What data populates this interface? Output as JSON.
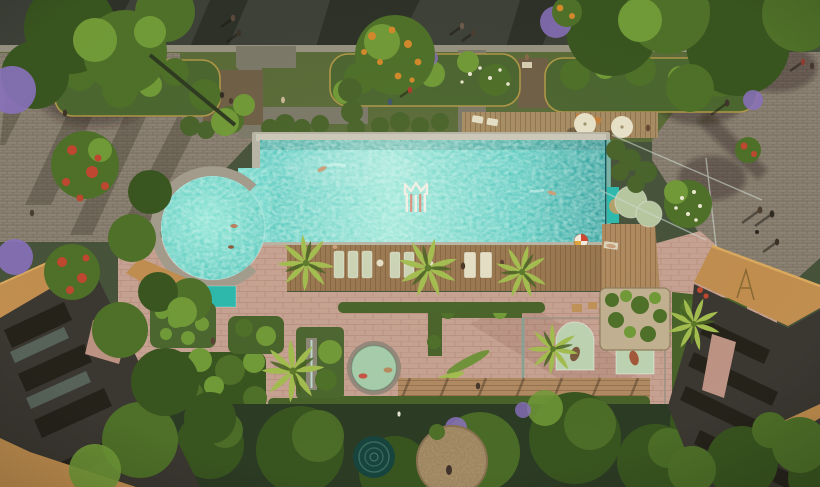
{
  "scene": {
    "alt": "Aerial rendering of a resort-style courtyard: large turquoise swimming pool with circular plunge pool and M monogram on the pool floor, wooden sun deck with loungers and palm trees, tropical garden terrace with spa jacuzzi and arched cabanas, brick plazas with pedestrians, a tree-lined road on top, and tan-roofed residential buildings at the lower corners",
    "logo_monogram": "M"
  },
  "palette": {
    "asphalt": "#3e4138",
    "sidewalk": "#989281",
    "plaza": "#8d8374",
    "garden_base": "#5a6b38",
    "path_gray": "#7d7969",
    "terrace_brown": "#6f5f46",
    "bed_green": "#4c6630",
    "bed_curb": "#af9747",
    "hedge": "#48632a",
    "canopy_dark": "#39551f",
    "canopy": "#4e7028",
    "canopy_light": "#719a37",
    "palm": "#a3bd4e",
    "flower_red": "#bf4730",
    "flower_purple": "#8971bd",
    "flower_orange": "#d3892b",
    "flower_white": "#ece9d2",
    "pool_coping": "#b9b5a6",
    "pool_mosaic": "#cdc9ba",
    "pool_light": "#8fe3d6",
    "pool_mid": "#46c4ba",
    "pool_deep": "#1f9694",
    "circle_pool_light": "#7fe4d4",
    "circle_pool": "#3fc0b4",
    "ring": "#a39c8d",
    "shelf_teal": "#2cb9ad",
    "deck_wood": "#99774f",
    "deck_upper": "#a88d63",
    "bridge_wood": "#b08a62",
    "lounger_pale": "#ccd4b6",
    "lounger_cream": "#e5dfc6",
    "umbrella": "#e9e2c8",
    "disc_sage": "#b7c8a0",
    "disc_khaki": "#b2a26b",
    "terrace_pink": "#c7a292",
    "cabana": "#bed3b2",
    "spa_water": "#a7cdab",
    "spa_rim": "#94897a",
    "lotus_pale": "#c2b191",
    "courtyard": "#2c3b24",
    "dark_pool": "#17443c",
    "gravel": "#b2986e",
    "roof_tan": "#c18e4f",
    "roof_tan_light": "#d9a95e",
    "facade": "#3b3731",
    "facade_dark": "#242119",
    "glass": "#cfdcd2",
    "logo_white": "#f2efe6",
    "logo_coral": "#d88f7e",
    "skin": "#caa07a",
    "splash": "#eafff8"
  }
}
